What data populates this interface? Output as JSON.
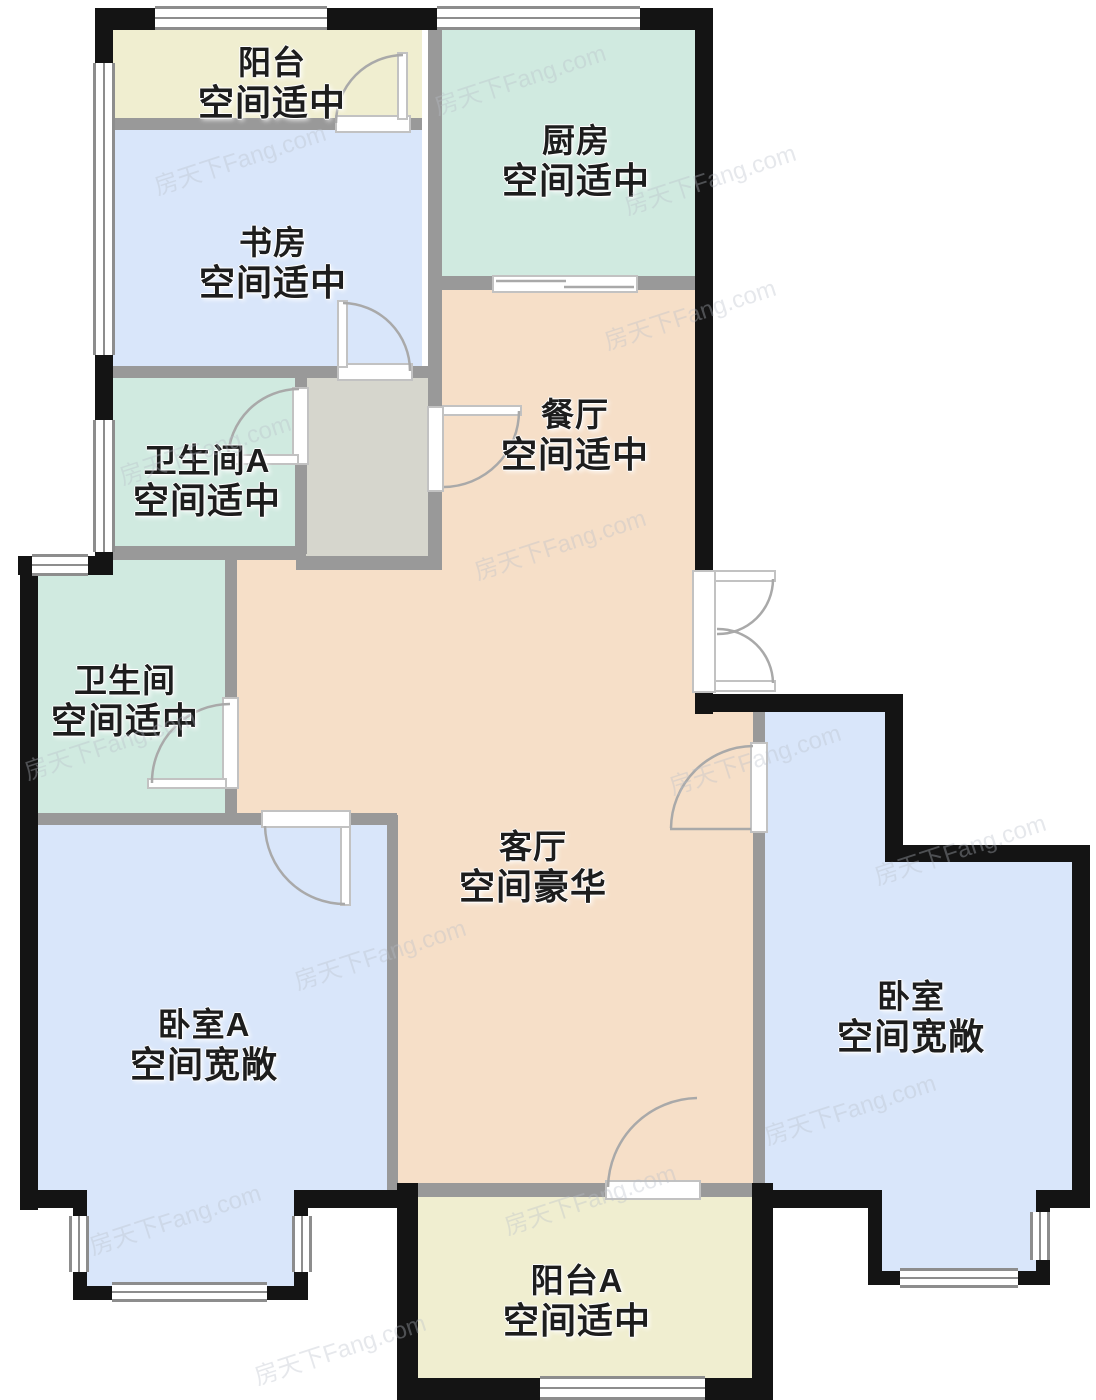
{
  "floorplan": {
    "watermark": "房天下Fang.com",
    "rooms": [
      {
        "id": "balcony",
        "name": "阳台",
        "desc": "空间适中"
      },
      {
        "id": "kitchen",
        "name": "厨房",
        "desc": "空间适中"
      },
      {
        "id": "study",
        "name": "书房",
        "desc": "空间适中"
      },
      {
        "id": "bathroom_a",
        "name": "卫生间A",
        "desc": "空间适中"
      },
      {
        "id": "dining",
        "name": "餐厅",
        "desc": "空间适中"
      },
      {
        "id": "bathroom",
        "name": "卫生间",
        "desc": "空间适中"
      },
      {
        "id": "living",
        "name": "客厅",
        "desc": "空间豪华"
      },
      {
        "id": "bedroom_a",
        "name": "卧室A",
        "desc": "空间宽敞"
      },
      {
        "id": "bedroom",
        "name": "卧室",
        "desc": "空间宽敞"
      },
      {
        "id": "balcony_a",
        "name": "阳台A",
        "desc": "空间适中"
      }
    ],
    "colors": {
      "balcony_cream": "#f0eed0",
      "bedroom_blue": "#d9e6fa",
      "bath_teal": "#d0eae0",
      "living_peach": "#f6dfc8",
      "hall_gray": "#d6d6cd",
      "wall_exterior": "#141414",
      "wall_interior": "#999999"
    }
  }
}
